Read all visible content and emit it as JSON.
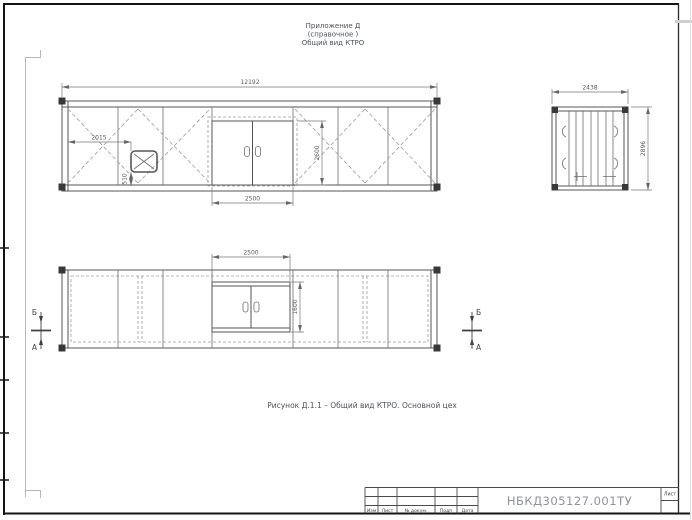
{
  "page": {
    "header_lines": [
      "Приложение Д",
      "(справочное )",
      "Общий вид КТРО"
    ],
    "caption": "Рисунок Д.1.1 – Общий вид КТРО. Основной цех"
  },
  "side_view": {
    "dim_overall_length": "12192",
    "dim_vent_offset": "2015",
    "dim_vent_bottom_height": "510",
    "dim_door_width": "2500",
    "dim_door_height": "2600"
  },
  "plan_view": {
    "dim_door_width": "2500",
    "dim_door_depth": "1600"
  },
  "end_view": {
    "dim_width": "2438",
    "dim_height": "2896"
  },
  "section_markers": {
    "top_label": "Б",
    "bottom_label": "А"
  },
  "title_block": {
    "doc_number": "НБКД305127.001ТУ",
    "columns": [
      "Изм",
      "Лист",
      "№ докум.",
      "Подп",
      "Дата"
    ],
    "sheet_label": "Лист"
  },
  "colors": {
    "line": "#555555",
    "accent_text": "#4b5259",
    "doc_number_text": "#8e9298"
  }
}
